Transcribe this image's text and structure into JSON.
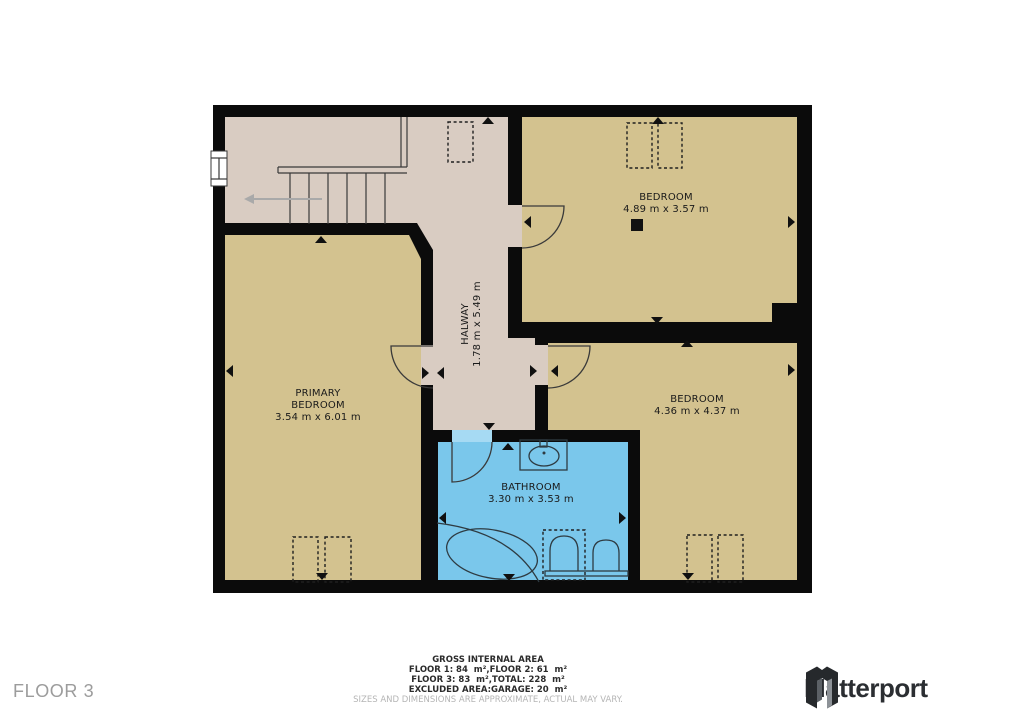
{
  "floor_label": "FLOOR 3",
  "rooms": {
    "bedroom_top": {
      "name": "BEDROOM",
      "dims": "4.89 m x 3.57 m"
    },
    "primary_bedroom": {
      "name_line1": "PRIMARY",
      "name_line2": "BEDROOM",
      "dims": "3.54 m x 6.01 m"
    },
    "bedroom_right": {
      "name": "BEDROOM",
      "dims": "4.36 m x 4.37 m"
    },
    "bathroom": {
      "name": "BATHROOM",
      "dims": "3.30 m x 3.53 m"
    },
    "hallway": {
      "name": "HALWAY",
      "dims": "1.78 m x 5.49 m"
    }
  },
  "footer": {
    "title": "GROSS INTERNAL AREA",
    "line1": "FLOOR 1: 84  m²,FLOOR 2: 61  m²",
    "line2": "FLOOR 3: 83  m²,TOTAL: 228  m²",
    "line3": "EXCLUDED AREA:GARAGE: 20  m²",
    "disclaimer": "SIZES AND DIMENSIONS ARE APPROXIMATE, ACTUAL MAY VARY."
  },
  "brand": {
    "name": "Matterport"
  },
  "colors": {
    "wall": "#0b0b0b",
    "hall_floor": "#d9ccc2",
    "bedroom_floor": "#d3c28f",
    "bathroom_floor": "#7ac7eb",
    "door_gap": "#a6daf3",
    "floor_label_color": "#9c9c9c"
  }
}
